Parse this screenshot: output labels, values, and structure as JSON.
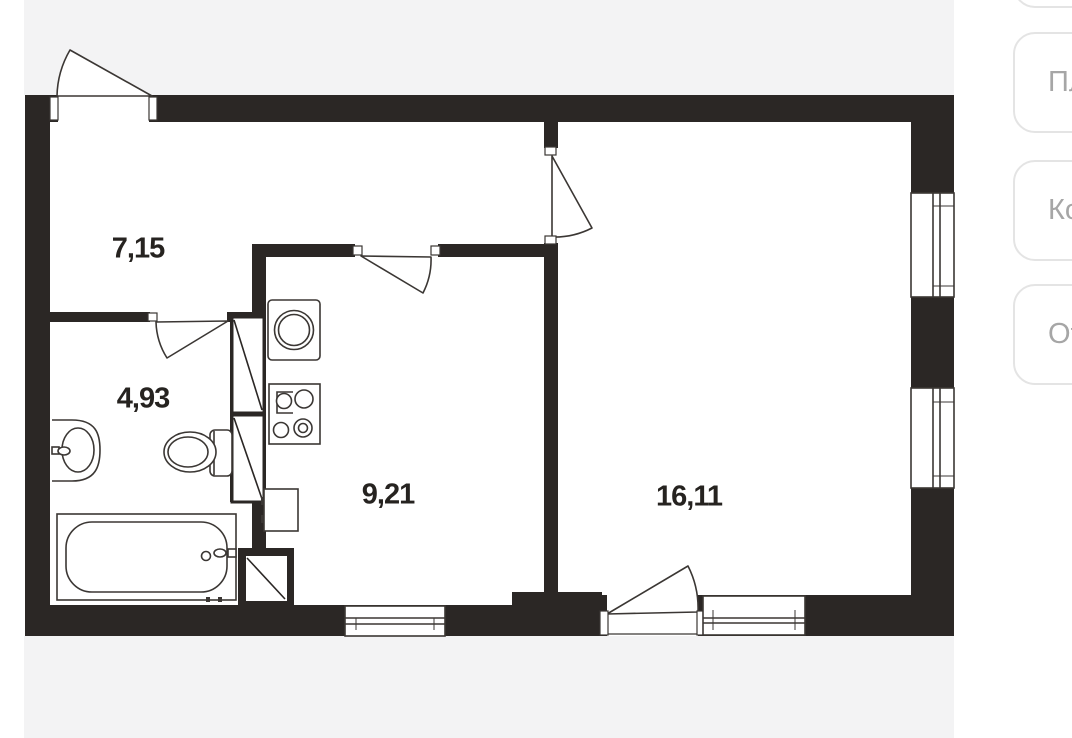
{
  "plan": {
    "rooms": [
      {
        "id": "hallway",
        "area": "7,15"
      },
      {
        "id": "bathroom",
        "area": "4,93"
      },
      {
        "id": "kitchen",
        "area": "9,21"
      },
      {
        "id": "living_room",
        "area": "16,11"
      }
    ]
  },
  "side_panel": {
    "buttons": [
      {
        "label": ""
      },
      {
        "label": "Пл"
      },
      {
        "label": "Ко"
      },
      {
        "label": "От"
      }
    ]
  },
  "colors": {
    "wall": "#2b2725",
    "line": "#3b3734",
    "background_band": "#f3f3f4",
    "button_border": "#e4e4e4",
    "button_text": "#a6a6a6",
    "label_text": "#262320"
  }
}
